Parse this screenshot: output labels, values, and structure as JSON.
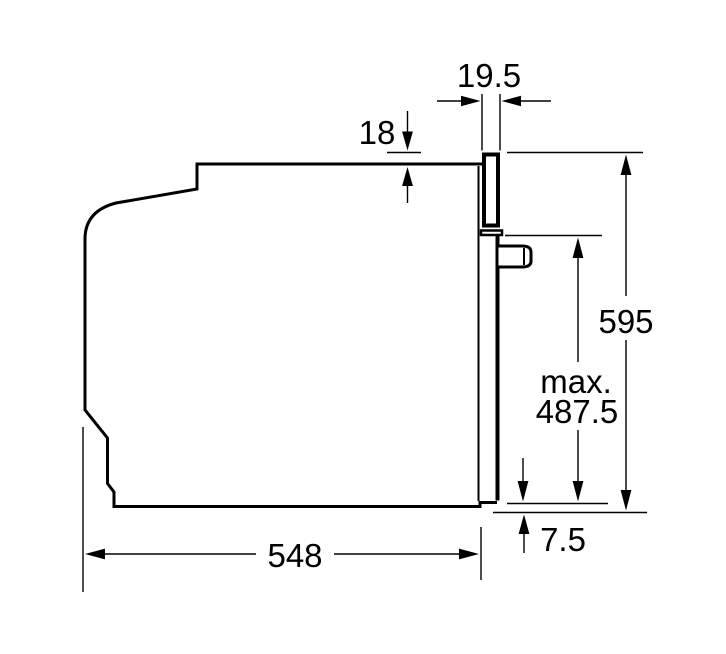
{
  "drawing": {
    "background_color": "#ffffff",
    "line_color": "#000000",
    "dimensions": {
      "door_front_thickness": "19.5",
      "top_offset": "18",
      "height": "595",
      "max_prefix": "max.",
      "max_value": "487.5",
      "bottom_offset": "7.5",
      "depth": "548"
    }
  }
}
